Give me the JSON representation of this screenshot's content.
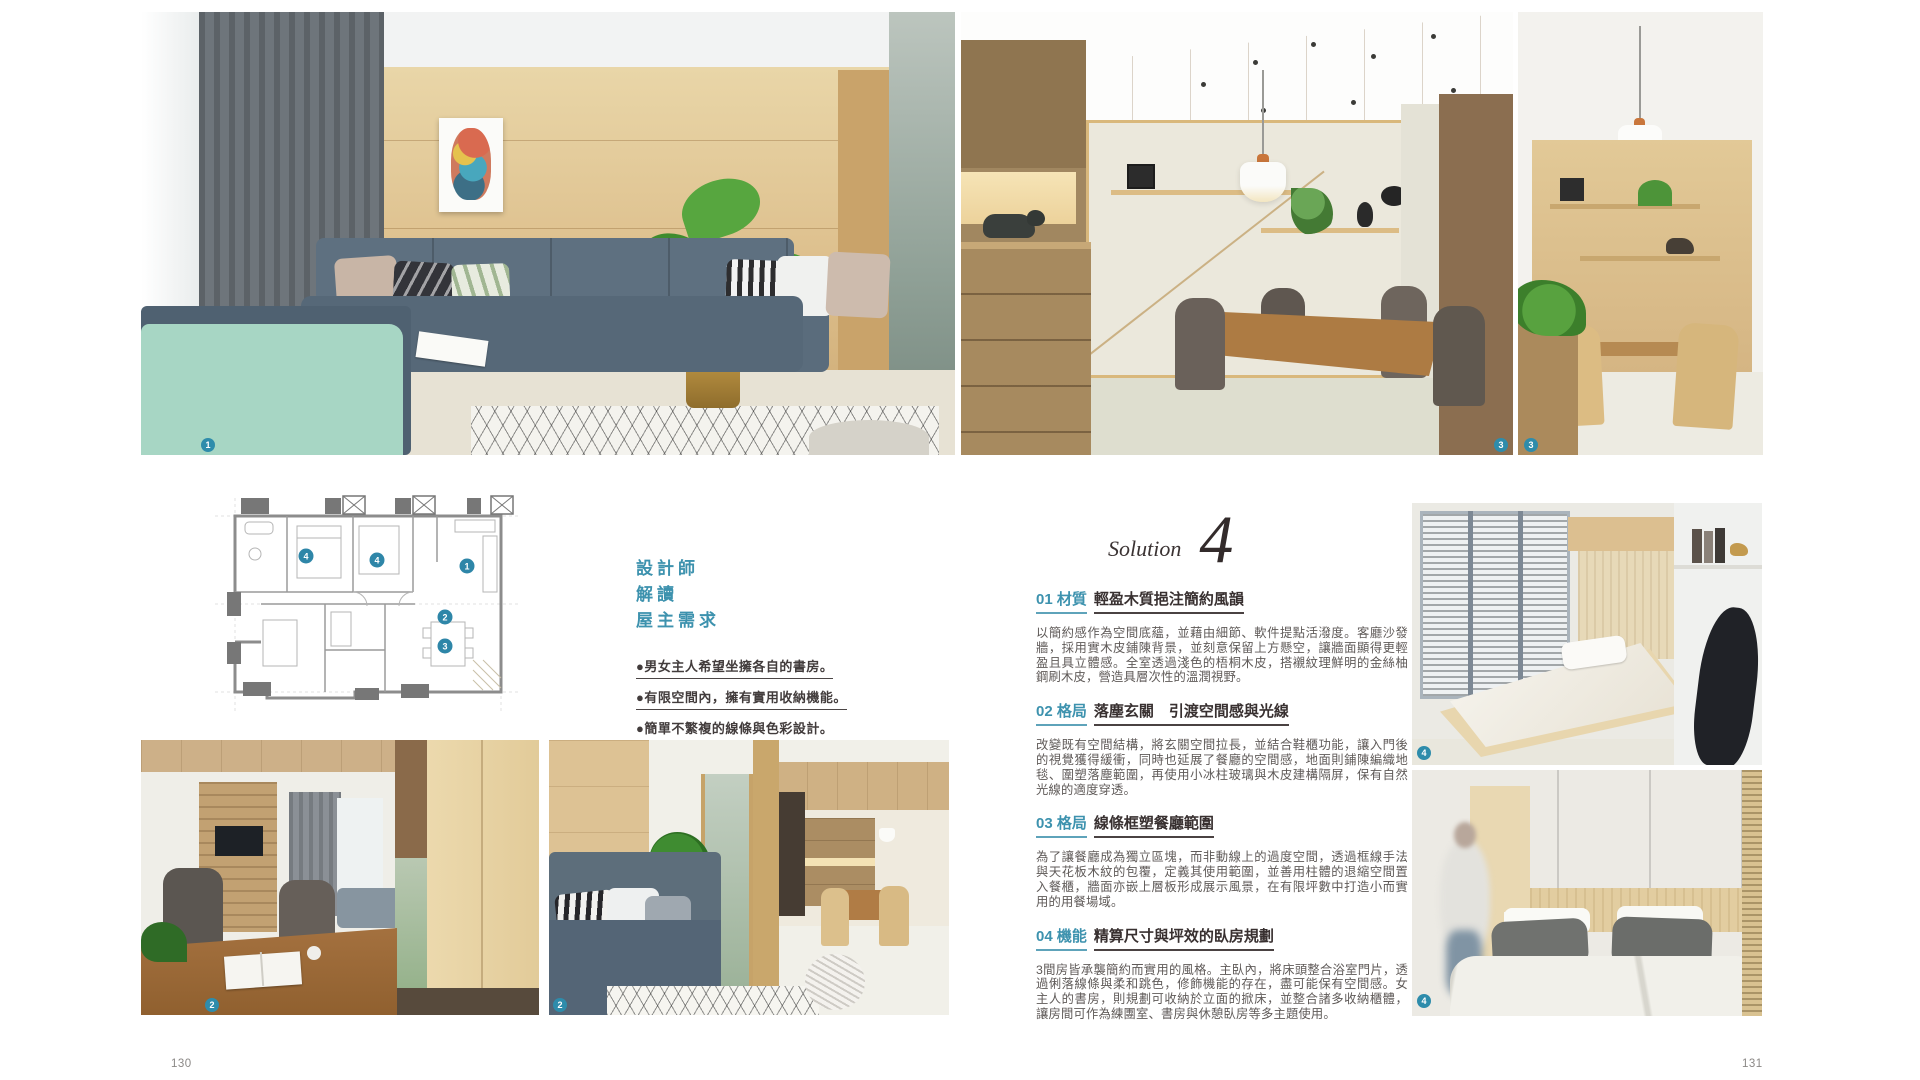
{
  "page": {
    "header": "DESIGN",
    "left_number": "130",
    "right_number": "131"
  },
  "solution": {
    "label": "Solution",
    "number": "4"
  },
  "designer_notes": {
    "title_line1": "設計師",
    "title_line2": "解讀",
    "title_line3": "屋主需求",
    "bullet1": "●男女主人希望坐擁各自的書房。",
    "bullet2": "●有限空間內，擁有實用收納機能。",
    "bullet3": "●簡單不繁複的線條與色彩設計。"
  },
  "sections": [
    {
      "num": "01",
      "category": "材質",
      "heading": "01 材質",
      "title": "輕盈木質挹注簡約風韻",
      "body": "以簡約感作為空間底蘊，並藉由細節、軟件提點活潑度。客廳沙發牆，採用實木皮鋪陳背景，並刻意保留上方懸空，讓牆面顯得更輕盈且具立體感。全室透過淺色的梧桐木皮，搭襯紋理鮮明的金絲柚鋼刷木皮，營造具層次性的溫潤視野。"
    },
    {
      "num": "02",
      "category": "格局",
      "heading": "02 格局",
      "title": "落塵玄關　引渡空間感與光線",
      "body": "改變既有空間結構，將玄關空間拉長，並結合鞋櫃功能，讓入門後的視覺獲得緩衝，同時也延展了餐廳的空間感，地面則鋪陳編織地毯、圍塑落塵範圍，再使用小冰柱玻璃與木皮建構隔屏，保有自然光線的適度穿透。"
    },
    {
      "num": "03",
      "category": "格局",
      "heading": "03 格局",
      "title": "線條框塑餐廳範圍",
      "body": "為了讓餐廳成為獨立區塊，而非動線上的過度空間，透過框線手法與天花板木紋的包覆，定義其使用範圍，並善用柱體的退縮空間置入餐櫃，牆面亦嵌上層板形成展示風景，在有限坪數中打造小而實用的用餐場域。"
    },
    {
      "num": "04",
      "category": "機能",
      "heading": "04 機能",
      "title": "精算尺寸與坪效的臥房規劃",
      "body": "3間房皆承襲簡約而實用的風格。主臥內，將床頭整合浴室門片，透過俐落線條與柔和跳色，修飾機能的存在，盡可能保有空間感。女主人的書房，則規劃可收納於立面的掀床，並整合諸多收納櫃體，讓房間可作為練團室、書房與休憩臥房等多主題使用。"
    }
  ],
  "photos": [
    {
      "id": "living-room",
      "badge": "1"
    },
    {
      "id": "dining-room",
      "badge": "3"
    },
    {
      "id": "dining-nook",
      "badge": "3"
    },
    {
      "id": "study-corridor",
      "badge": "2"
    },
    {
      "id": "entry-sofa",
      "badge": "2"
    },
    {
      "id": "murphy-bed-room",
      "badge": "4"
    },
    {
      "id": "master-bedroom",
      "badge": "4"
    }
  ],
  "floor_plan": {
    "marker1": "1",
    "marker2": "2",
    "marker3": "3",
    "marker4a": "4",
    "marker4b": "4"
  },
  "colors": {
    "accent_teal": "#3d92ae",
    "badge_teal": "#2e8cab",
    "heading_dark": "#383030",
    "body_text": "#5f5a58",
    "wood_light": "#dcbd8a"
  }
}
